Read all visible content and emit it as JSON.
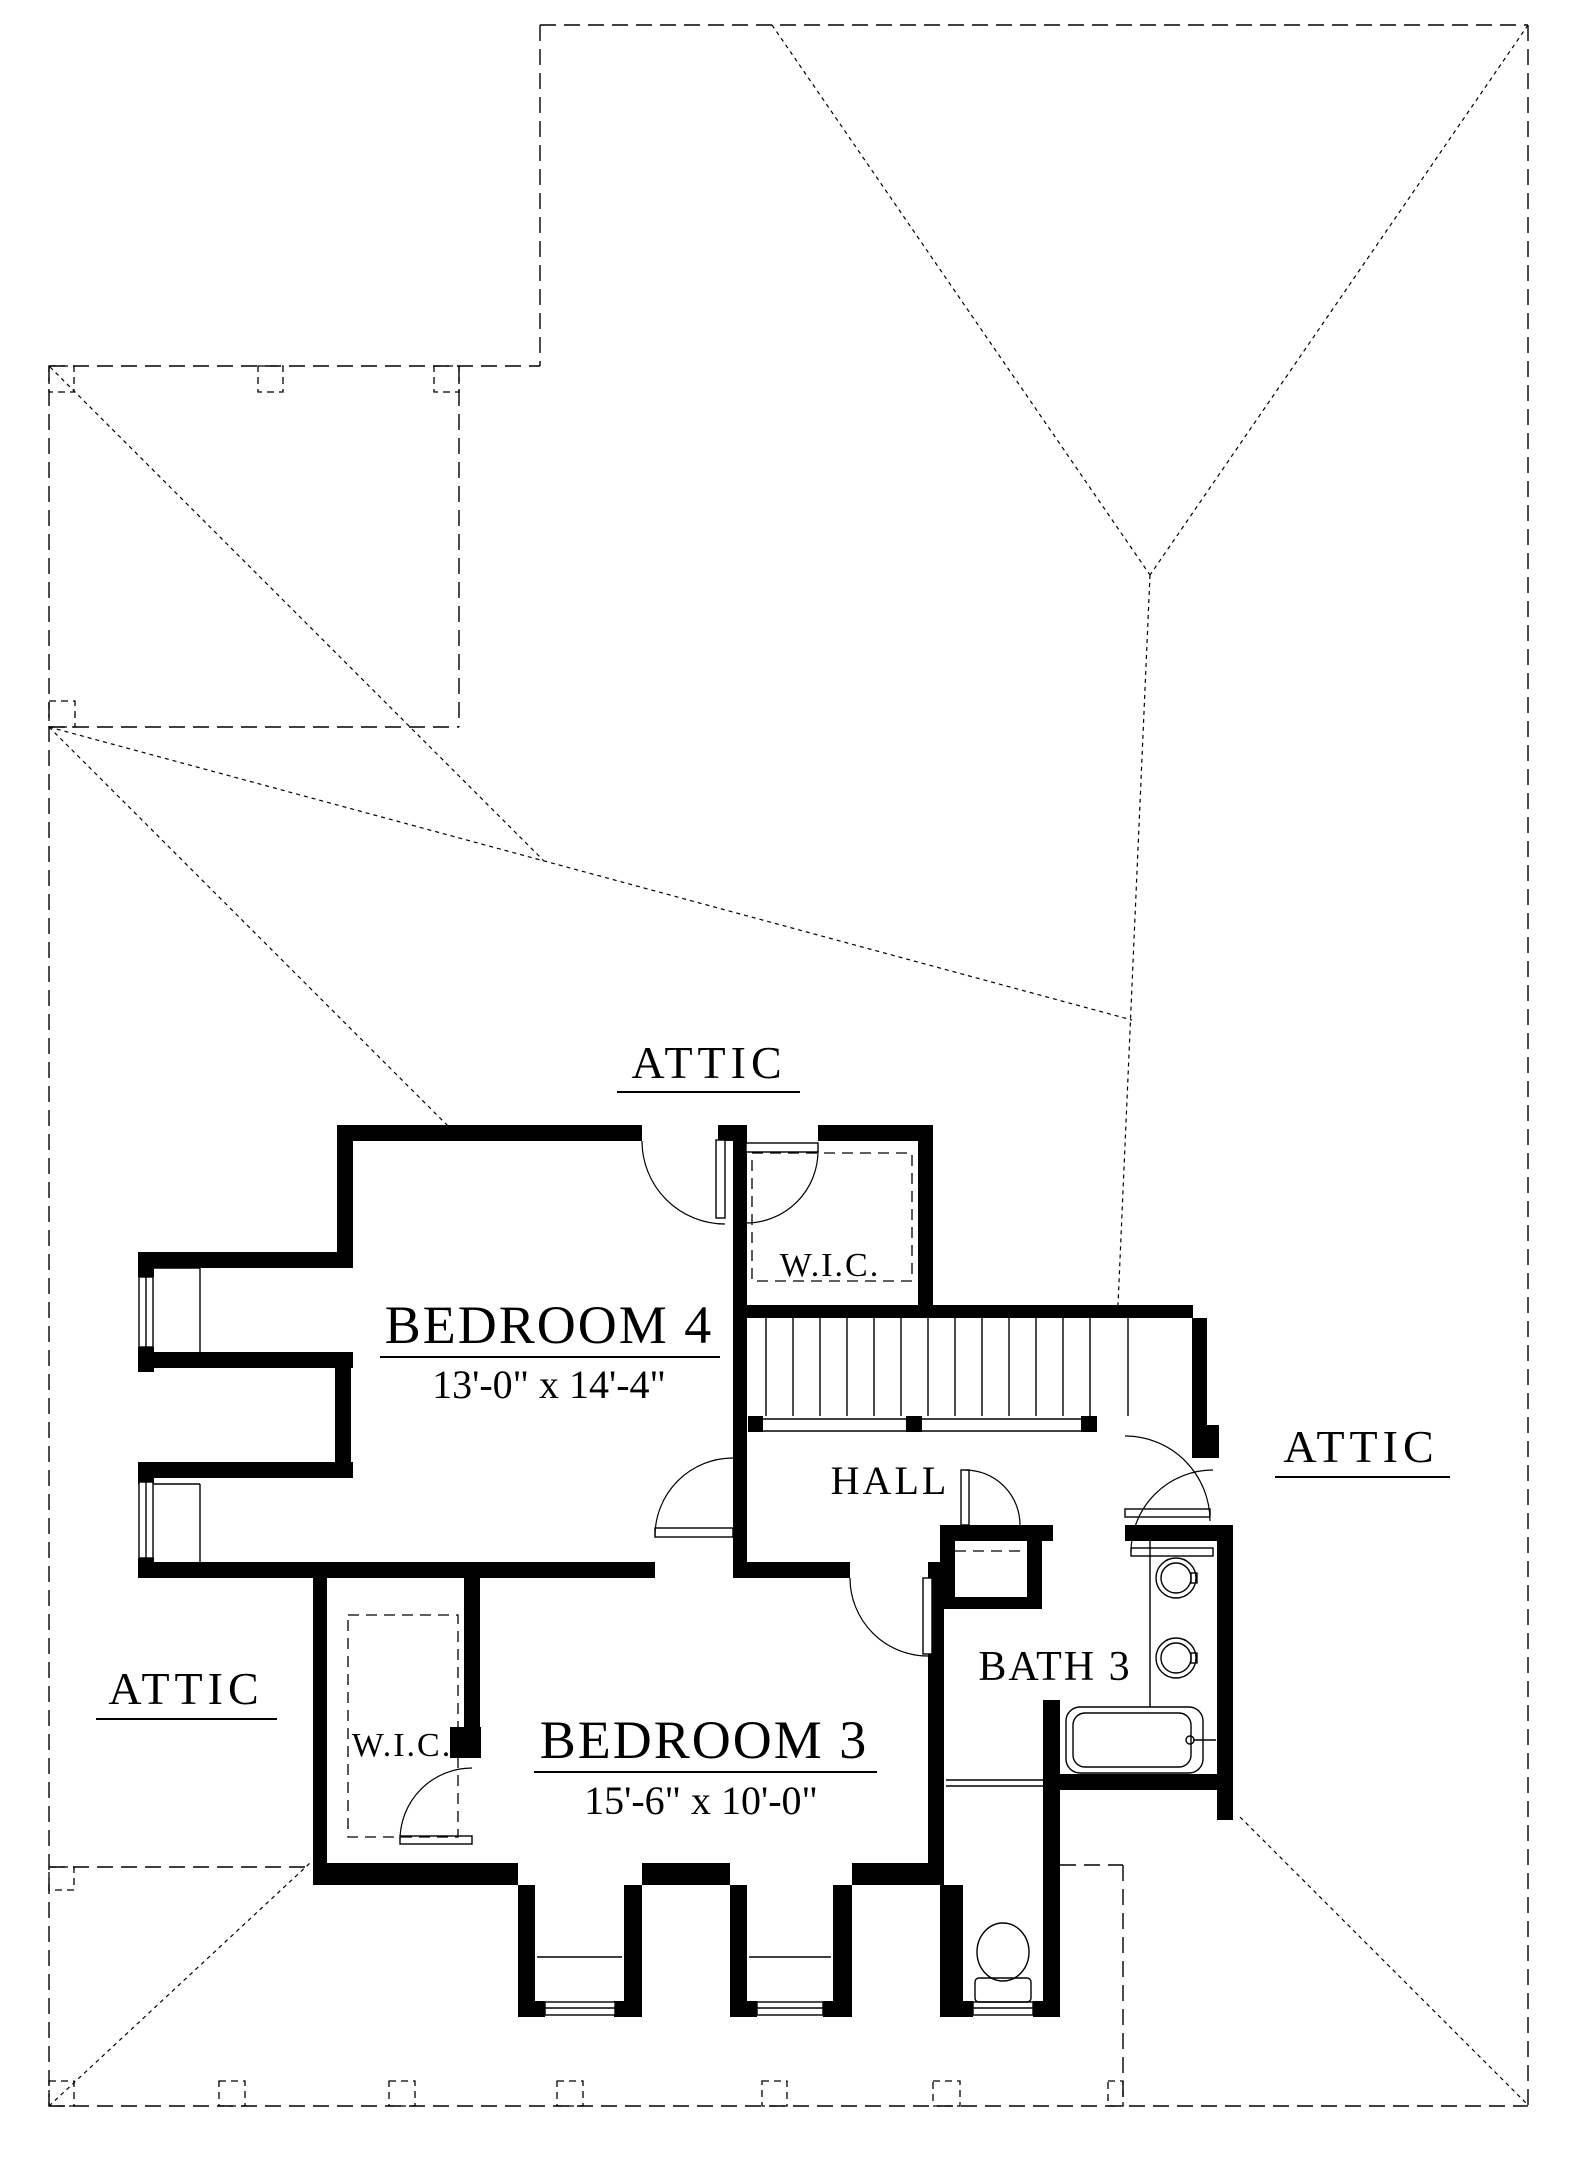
{
  "drawing": {
    "type": "second-floor-plan",
    "colors": {
      "ink": "#000000",
      "paper": "#ffffff"
    },
    "labels": {
      "attic_top": "ATTIC",
      "attic_left": "ATTIC",
      "attic_right": "ATTIC",
      "hall": "HALL",
      "bath3": "BATH 3",
      "wic_upper": "W.I.C.",
      "wic_lower": "W.I.C.",
      "bedroom4": {
        "name": "BEDROOM 4",
        "dims": "13'-0\" x 14'-4\""
      },
      "bedroom3": {
        "name": "BEDROOM 3",
        "dims": "15'-6\" x 10'-0\""
      }
    }
  }
}
